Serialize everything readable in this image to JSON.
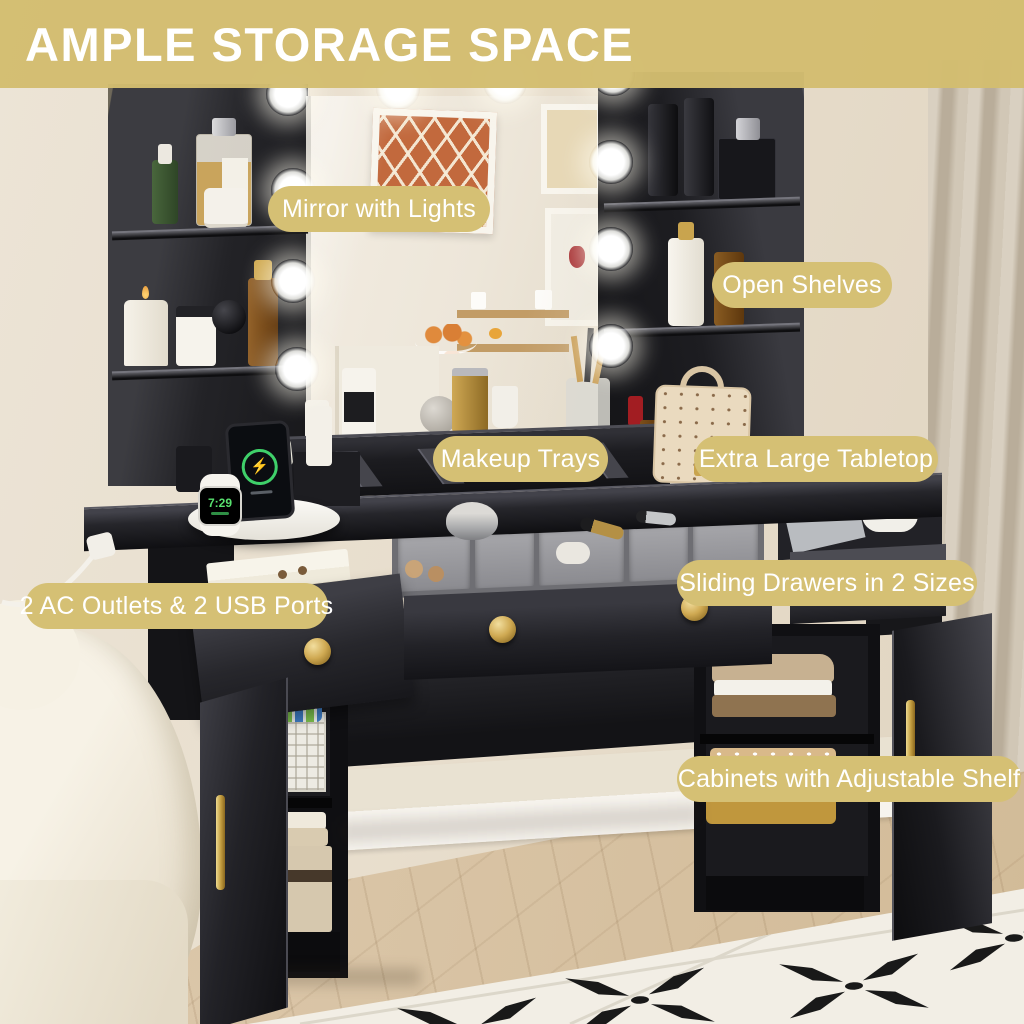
{
  "banner": {
    "title": "AMPLE STORAGE SPACE"
  },
  "callouts": {
    "mirror": "Mirror with Lights",
    "open_shelves": "Open Shelves",
    "makeup_trays": "Makeup Trays",
    "tabletop": "Extra Large Tabletop",
    "outlets": "2 AC Outlets & 2 USB Ports",
    "drawers": "Sliding Drawers in 2 Sizes",
    "cabinets": "Cabinets with Adjustable Shelf"
  },
  "devices": {
    "watch_time": "7:29",
    "charging_icon": "⚡"
  },
  "colors": {
    "accent_gold": "#d5c074",
    "furniture_black": "#1b1b1e",
    "hardware_gold": "#c9a44e",
    "wall_cream": "#e9e0cf",
    "wood_floor": "#d7c2a4",
    "rug_white": "#f2eee5",
    "rug_black": "#1a1a1a",
    "charge_green": "#3fd06a"
  }
}
